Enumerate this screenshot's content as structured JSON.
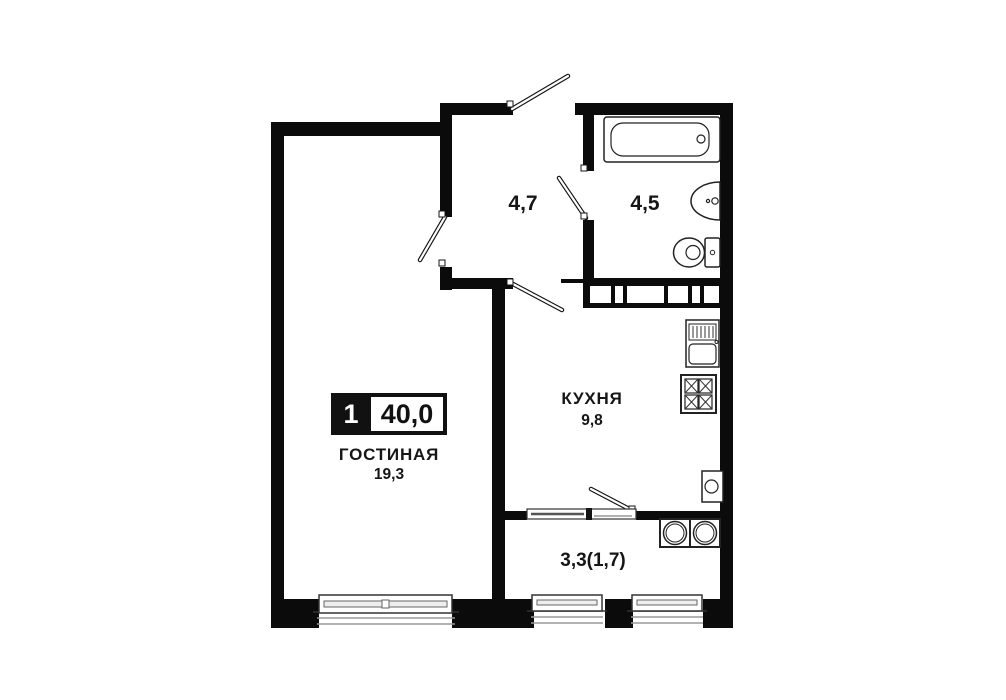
{
  "plan": {
    "badge": {
      "rooms_count": "1",
      "total_area": "40,0"
    },
    "rooms": [
      {
        "id": "living",
        "name": "ГОСТИНАЯ",
        "area": "19,3"
      },
      {
        "id": "kitchen",
        "name": "КУХНЯ",
        "area": "9,8"
      },
      {
        "id": "hall",
        "name": "",
        "area": "4,7"
      },
      {
        "id": "bathroom",
        "name": "",
        "area": "4,5"
      },
      {
        "id": "balcony",
        "name": "",
        "area": "3,3(1,7)"
      }
    ],
    "fixtures": [
      "bathtub",
      "washbasin",
      "toilet",
      "kitchen-sink",
      "stove",
      "washing-machine",
      "washer-dryer-pair"
    ],
    "colors": {
      "wall": "#0b0b0b",
      "background": "#ffffff",
      "fixture_outline": "#222222",
      "sill_gray": "#999999",
      "text": "#161616"
    }
  }
}
